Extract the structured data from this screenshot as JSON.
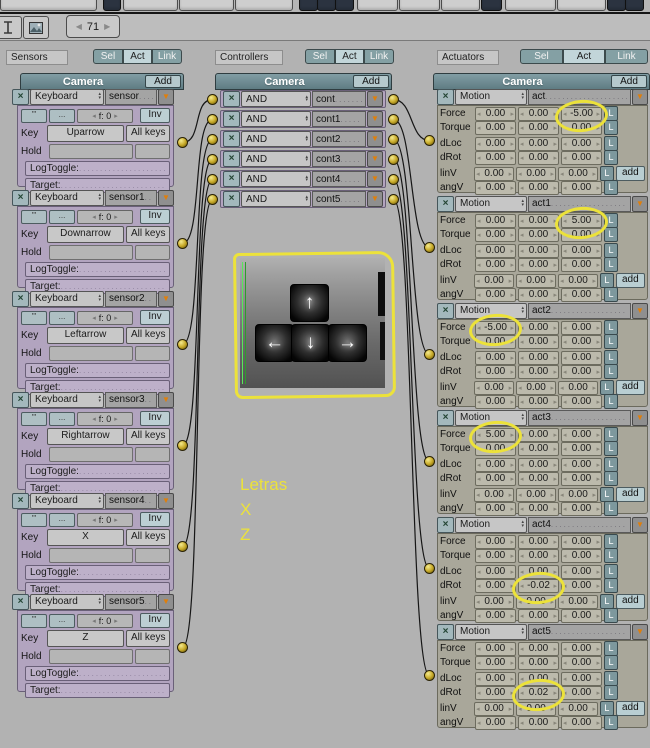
{
  "top": {
    "frame_value": "71"
  },
  "filters": [
    "Sel",
    "Act",
    "Link"
  ],
  "sensors": {
    "label": "Sensors",
    "panel_title": "Camera",
    "add_label": "Add",
    "pulse_icons": [
      "'''",
      "..."
    ],
    "field_labels": {
      "key": "Key",
      "all_keys": "All keys",
      "hold": "Hold",
      "logtoggle": "LogToggle:",
      "target": "Target:",
      "inv": "Inv",
      "freq": "f: 0"
    },
    "items": [
      {
        "type": "Keyboard",
        "name": "sensor",
        "key": "Uparrow"
      },
      {
        "type": "Keyboard",
        "name": "sensor1",
        "key": "Downarrow"
      },
      {
        "type": "Keyboard",
        "name": "sensor2",
        "key": "Leftarrow"
      },
      {
        "type": "Keyboard",
        "name": "sensor3",
        "key": "Rightarrow"
      },
      {
        "type": "Keyboard",
        "name": "sensor4",
        "key": "X"
      },
      {
        "type": "Keyboard",
        "name": "sensor5",
        "key": "Z"
      }
    ]
  },
  "controllers": {
    "label": "Controllers",
    "panel_title": "Camera",
    "add_label": "Add",
    "items": [
      {
        "type": "AND",
        "name": "cont"
      },
      {
        "type": "AND",
        "name": "cont1"
      },
      {
        "type": "AND",
        "name": "cont2"
      },
      {
        "type": "AND",
        "name": "cont3"
      },
      {
        "type": "AND",
        "name": "cont4"
      },
      {
        "type": "AND",
        "name": "cont5"
      }
    ]
  },
  "actuators": {
    "label": "Actuators",
    "panel_title": "Camera",
    "add_label": "Add",
    "row_labels": [
      "Force",
      "Torque",
      "dLoc",
      "dRot",
      "linV",
      "angV"
    ],
    "l_label": "L",
    "add_button_label": "add",
    "items": [
      {
        "type": "Motion",
        "name": "act",
        "force": [
          "0.00",
          "0.00",
          "-5.00"
        ],
        "torque": [
          "0.00",
          "0.00",
          "0.00"
        ],
        "dloc": [
          "0.00",
          "0.00",
          "0.00"
        ],
        "drot": [
          "0.00",
          "0.00",
          "0.00"
        ],
        "linv": [
          "0.00",
          "0.00",
          "0.00"
        ],
        "angv": [
          "0.00",
          "0.00",
          "0.00"
        ],
        "highlight": {
          "row": "force",
          "col": 2
        }
      },
      {
        "type": "Motion",
        "name": "act1",
        "force": [
          "0.00",
          "0.00",
          "5.00"
        ],
        "torque": [
          "0.00",
          "0.00",
          "0.00"
        ],
        "dloc": [
          "0.00",
          "0.00",
          "0.00"
        ],
        "drot": [
          "0.00",
          "0.00",
          "0.00"
        ],
        "linv": [
          "0.00",
          "0.00",
          "0.00"
        ],
        "angv": [
          "0.00",
          "0.00",
          "0.00"
        ],
        "highlight": {
          "row": "force",
          "col": 2
        }
      },
      {
        "type": "Motion",
        "name": "act2",
        "force": [
          "-5.00",
          "0.00",
          "0.00"
        ],
        "torque": [
          "0.00",
          "0.00",
          "0.00"
        ],
        "dloc": [
          "0.00",
          "0.00",
          "0.00"
        ],
        "drot": [
          "0.00",
          "0.00",
          "0.00"
        ],
        "linv": [
          "0.00",
          "0.00",
          "0.00"
        ],
        "angv": [
          "0.00",
          "0.00",
          "0.00"
        ],
        "highlight": {
          "row": "force",
          "col": 0
        }
      },
      {
        "type": "Motion",
        "name": "act3",
        "force": [
          "5.00",
          "0.00",
          "0.00"
        ],
        "torque": [
          "0.00",
          "0.00",
          "0.00"
        ],
        "dloc": [
          "0.00",
          "0.00",
          "0.00"
        ],
        "drot": [
          "0.00",
          "0.00",
          "0.00"
        ],
        "linv": [
          "0.00",
          "0.00",
          "0.00"
        ],
        "angv": [
          "0.00",
          "0.00",
          "0.00"
        ],
        "highlight": {
          "row": "force",
          "col": 0
        }
      },
      {
        "type": "Motion",
        "name": "act4",
        "force": [
          "0.00",
          "0.00",
          "0.00"
        ],
        "torque": [
          "0.00",
          "0.00",
          "0.00"
        ],
        "dloc": [
          "0.00",
          "0.00",
          "0.00"
        ],
        "drot": [
          "0.00",
          "-0.02",
          "0.00"
        ],
        "linv": [
          "0.00",
          "0.00",
          "0.00"
        ],
        "angv": [
          "0.00",
          "0.00",
          "0.00"
        ],
        "highlight": {
          "row": "drot",
          "col": 1
        }
      },
      {
        "type": "Motion",
        "name": "act5",
        "force": [
          "0.00",
          "0.00",
          "0.00"
        ],
        "torque": [
          "0.00",
          "0.00",
          "0.00"
        ],
        "dloc": [
          "0.00",
          "0.00",
          "0.00"
        ],
        "drot": [
          "0.00",
          "0.02",
          "0.00"
        ],
        "linv": [
          "0.00",
          "0.00",
          "0.00"
        ],
        "angv": [
          "0.00",
          "0.00",
          "0.00"
        ],
        "highlight": {
          "row": "drot",
          "col": 1
        }
      }
    ]
  },
  "connections": {
    "sensor_to_controller": [
      [
        0,
        0
      ],
      [
        1,
        1
      ],
      [
        2,
        2
      ],
      [
        3,
        3
      ],
      [
        4,
        4
      ],
      [
        5,
        5
      ]
    ],
    "controller_to_actuator": [
      [
        0,
        0
      ],
      [
        1,
        1
      ],
      [
        2,
        2
      ],
      [
        3,
        3
      ],
      [
        4,
        4
      ],
      [
        5,
        5
      ]
    ]
  },
  "keypad": {
    "keys": [
      "↑",
      "←",
      "↓",
      "→"
    ]
  },
  "annotations": {
    "color": "#ece23a",
    "letras": [
      "Letras",
      "X",
      "Z"
    ],
    "underline_keys": [
      0,
      1,
      2,
      3,
      4,
      5
    ],
    "underline_long": 5
  }
}
